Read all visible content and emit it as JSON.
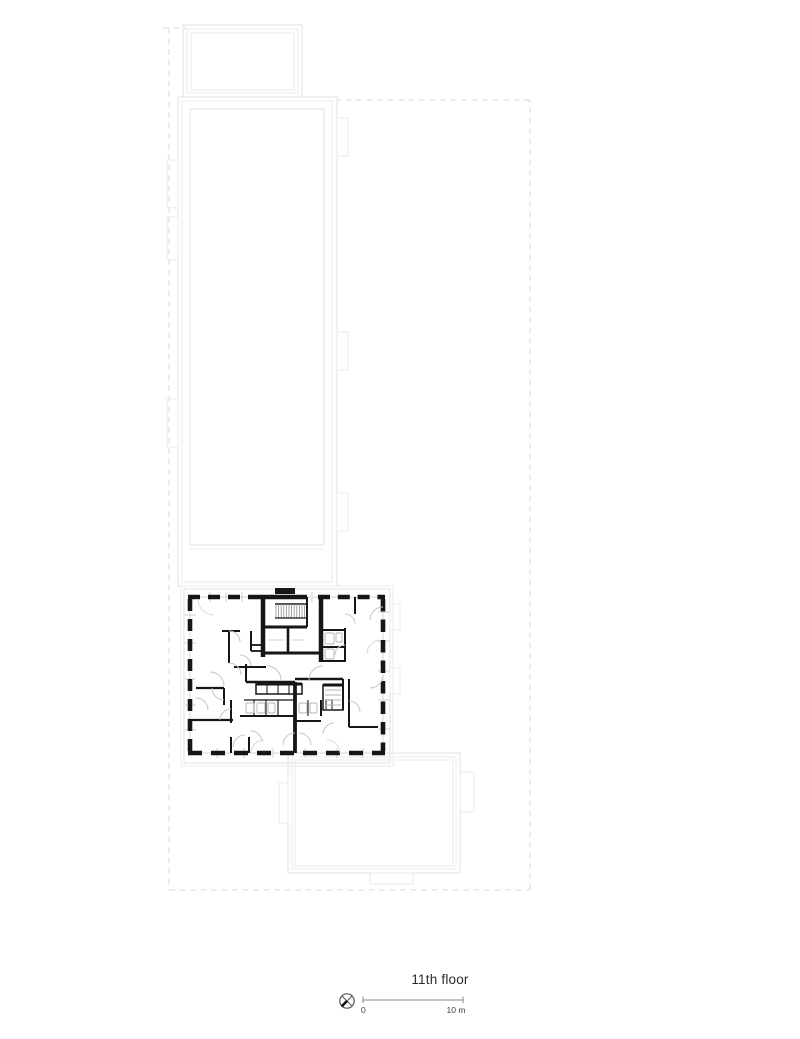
{
  "title": {
    "text": "11th floor"
  },
  "scale_bar": {
    "zero_label": "0",
    "max_label": "10 m"
  },
  "icons": {
    "north_arrow": "north-arrow-icon",
    "stair": "stair-hatch-icon"
  },
  "colors": {
    "bg": "#ffffff",
    "wall": "#161616",
    "outline": "#e0e0e0",
    "outline2": "#ebebeb",
    "boundary": "#d9d9d9",
    "glazing": "#d6d6d6",
    "arc": "#c6c6c6",
    "arc-faint": "#dadada",
    "fixture": "#b3b3b3",
    "hatch": "#8f8f8f",
    "scale": "#8a8a8a",
    "north": "#555555",
    "text-dark": "#2b2b2b",
    "text-muted": "#3f3f3f"
  }
}
